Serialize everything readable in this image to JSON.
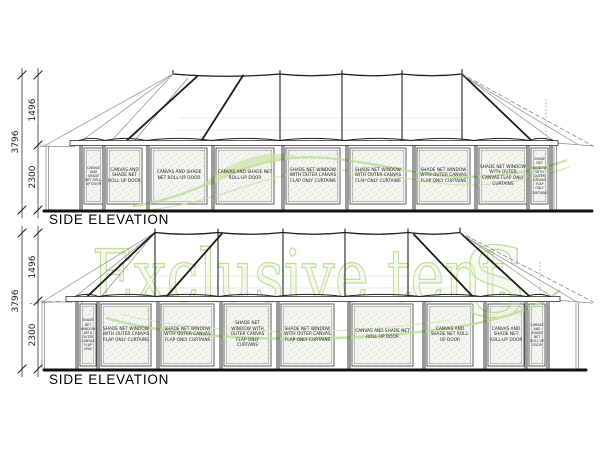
{
  "top_elevation": {
    "title": "SIDE ELEVATION",
    "dimensions": {
      "upper": "1496",
      "overall": "3796",
      "lower": "2300"
    },
    "panels": [
      {
        "x": 84,
        "w": 19,
        "text": "CANVAS AND SHADE NET ROLL-UP DOOR"
      },
      {
        "x": 107,
        "w": 35,
        "text": "CANVAS AND SHADE NET ROLL-UP DOOR"
      },
      {
        "x": 151,
        "w": 56,
        "text": "CANVAS AND SHADE NET ROLL-UP DOOR"
      },
      {
        "x": 216,
        "w": 58,
        "text": "CANVAS AND SHADE NET ROLL-UP DOOR"
      },
      {
        "x": 286,
        "w": 54,
        "text": "SHADE NET WINDOW WITH OUTER CANVAS FLAP ONLY CURTAINS"
      },
      {
        "x": 350,
        "w": 56,
        "text": "SHADE NET WINDOW WITH OUTER CANVAS FLAP ONLY CURTAINS"
      },
      {
        "x": 417,
        "w": 53,
        "text": "SHADE NET WINDOW WITH OUTER CANVAS FLAP ONLY CURTAINS"
      },
      {
        "x": 479,
        "w": 48,
        "text": "SHADE NET WINDOW WITH OUTER CANVAS FLAP ONLY CURTAINS"
      },
      {
        "x": 531,
        "w": 17,
        "text": "SHADE NET WINDOW WITH OUTER CANVAS FLAP ONLY CURTAINS"
      }
    ]
  },
  "bottom_elevation": {
    "title": "SIDE ELEVATION",
    "dimensions": {
      "upper": "1496",
      "overall": "3796",
      "lower": "2300"
    },
    "panels": [
      {
        "x": 80,
        "w": 16,
        "text": "SHADE NET WINDOW WITH OUTER CANVAS FLAP ONLY"
      },
      {
        "x": 101,
        "w": 50,
        "text": "SHADE NET WINDOW WITH OUTER CANVAS FLAP ONLY CURTAINS"
      },
      {
        "x": 161,
        "w": 53,
        "text": "SHADE NET WINDOW WITH OUTER CANVAS FLAP ONLY CURTAINS"
      },
      {
        "x": 224,
        "w": 47,
        "text": "SHADE NET WINDOW WITH OUTER CANVAS FLAP ONLY CURTAINS"
      },
      {
        "x": 281,
        "w": 53,
        "text": "SHADE NET WINDOW WITH OUTER CANVAS FLAP ONLY CURTAINS"
      },
      {
        "x": 352,
        "w": 61,
        "text": "CANVAS AND SHADE NET ROLL-UP DOOR"
      },
      {
        "x": 427,
        "w": 46,
        "text": "CANVAS AND SHADE NET ROLL-UP DOOR"
      },
      {
        "x": 488,
        "w": 36,
        "text": "CANVAS AND SHADE NET ROLL-UP DOOR"
      },
      {
        "x": 529,
        "w": 16,
        "text": "CANVAS AND SHADE NET ROLL UP DOOR"
      }
    ]
  },
  "watermark": {
    "text": "Exclusive tent",
    "cap": "S",
    "color": "#b5d488"
  }
}
